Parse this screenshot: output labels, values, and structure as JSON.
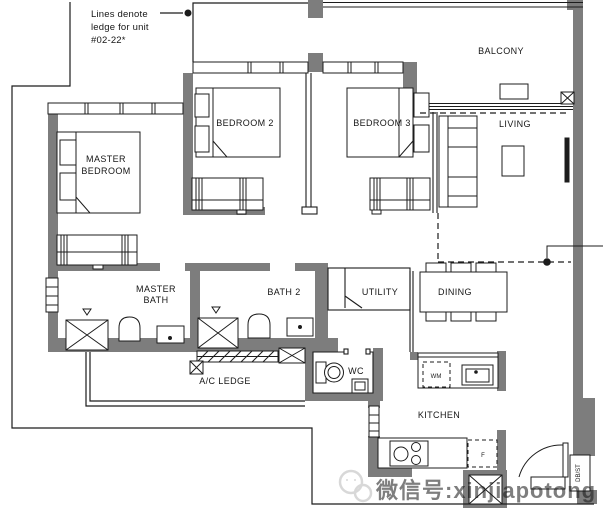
{
  "annotation": {
    "line1": "Lines denote",
    "line2": "ledge for unit",
    "line3": "#02-22*"
  },
  "rooms": {
    "master_bedroom": {
      "line1": "MASTER",
      "line2": "BEDROOM"
    },
    "bedroom2": "BEDROOM 2",
    "bedroom3": "BEDROOM 3",
    "balcony": "BALCONY",
    "living": "LIVING",
    "master_bath": {
      "line1": "MASTER",
      "line2": "BATH"
    },
    "bath2": "BATH 2",
    "utility": "UTILITY",
    "dining": "DINING",
    "wc": "WC",
    "ac_ledge": "A/C LEDGE",
    "kitchen": "KITCHEN"
  },
  "fixtures": {
    "washing_machine": "WM",
    "fridge": "F",
    "db_st": "DB/ST"
  },
  "watermark": "微信号:xinjiapotong",
  "colors": {
    "wall": "#7d7d7d",
    "line": "#1c1c1c",
    "watermark": "#b9b9b9"
  }
}
